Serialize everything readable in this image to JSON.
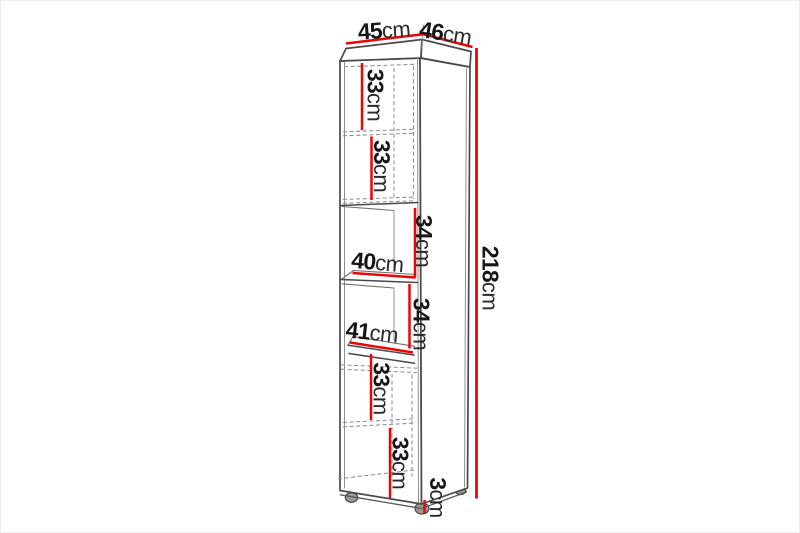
{
  "diagram": {
    "subject": "tall-cabinet-dimension-drawing",
    "colors": {
      "dimension_line": "#ea0606",
      "outline": "#4a4a4a",
      "hidden_line": "#8f8f8f",
      "label_text": "#161616",
      "background": "#ffffff"
    },
    "labels": {
      "top_width": {
        "num": "45",
        "unit": "cm"
      },
      "top_depth": {
        "num": "46",
        "unit": "cm"
      },
      "total_height": {
        "num": "218",
        "unit": "cm"
      },
      "section_1": {
        "num": "33",
        "unit": "cm"
      },
      "section_2": {
        "num": "33",
        "unit": "cm"
      },
      "section_3": {
        "num": "34",
        "unit": "cm"
      },
      "shelf_width_upper": {
        "num": "40",
        "unit": "cm"
      },
      "section_4": {
        "num": "34",
        "unit": "cm"
      },
      "shelf_width_lower": {
        "num": "41",
        "unit": "cm"
      },
      "section_5": {
        "num": "33",
        "unit": "cm"
      },
      "section_6": {
        "num": "33",
        "unit": "cm"
      },
      "feet_height": {
        "num": "3",
        "unit": "cm"
      }
    }
  }
}
